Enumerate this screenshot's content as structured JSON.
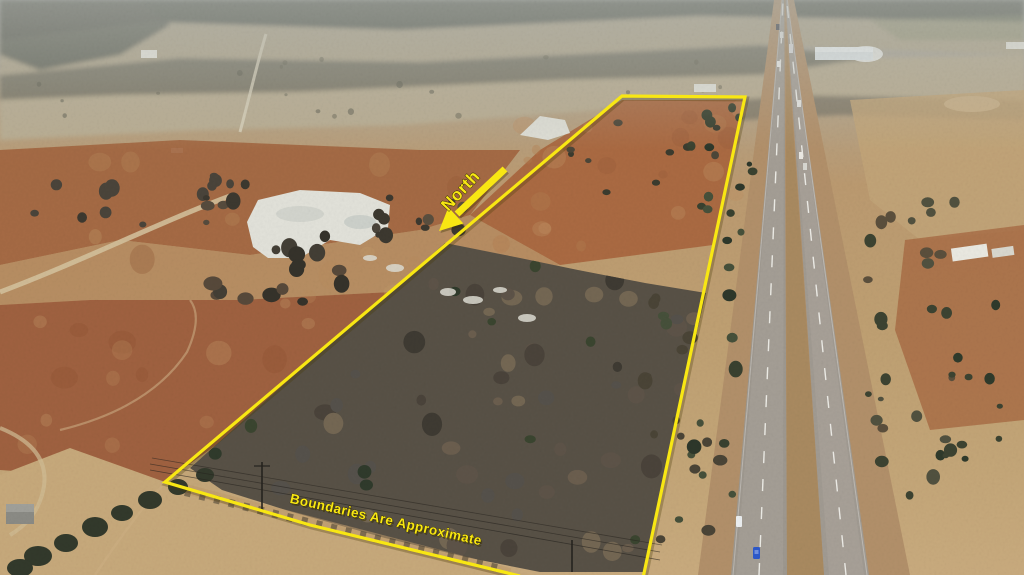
{
  "photo": {
    "kind": "aerial-drone-photo",
    "subject": "vacant land parcel outlined in yellow beside a divided highway"
  },
  "overlay": {
    "north_label": "North",
    "boundaries_note": "Boundaries Are Approximate",
    "boundary_color": "#f8e713",
    "text_color": "#f8e713",
    "shadow_color": "#3a3000"
  },
  "scene_colors": {
    "haze": "#aeb2ac",
    "field_tan": "#c7a97b",
    "field_rust": "#a2653f",
    "woodland": "#585146",
    "pavement": "#9e988f",
    "pond_ice": "#e2e2da",
    "blue_car": "#2d59cb"
  }
}
